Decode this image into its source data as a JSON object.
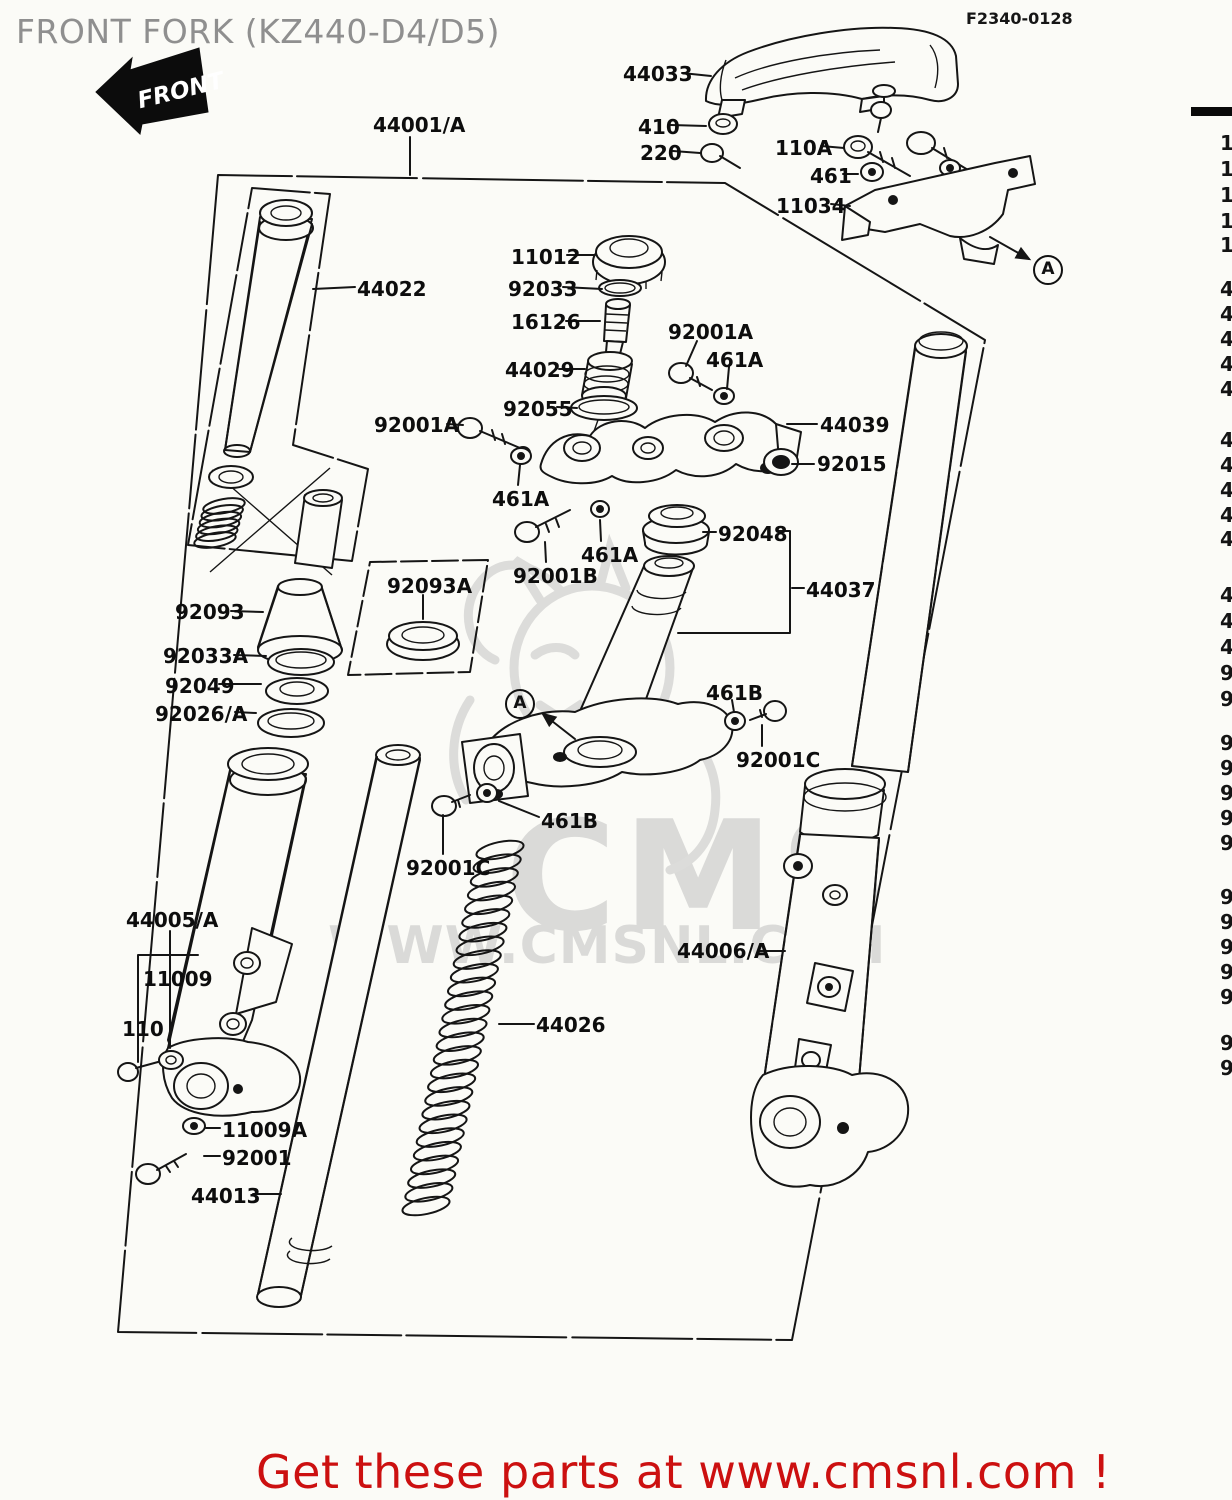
{
  "header": {
    "title": "FRONT FORK (KZ440-D4/D5)",
    "front_badge": "FRONT",
    "fiche_code": "F2340-0128"
  },
  "footer": {
    "promo": "Get these parts at www.cmsnl.com !"
  },
  "watermark": {
    "brand": "CMS",
    "url": "WWW.CMSNL.COM"
  },
  "colors": {
    "promo_red": "#cc1010",
    "title_gray": "#8f8f8f",
    "line_black": "#151515",
    "watermark_gray": "#dadad8",
    "background": "#fbfbf7"
  },
  "view_refs": [
    {
      "label": "A",
      "cx": 1046,
      "cy": 268,
      "arrow": [
        990,
        237,
        1029,
        259
      ]
    },
    {
      "label": "A",
      "cx": 518,
      "cy": 702,
      "arrow": [
        575,
        739,
        543,
        714
      ]
    }
  ],
  "part_labels": [
    {
      "text": "44033",
      "x": 623,
      "y": 62,
      "leader": [
        682,
        73,
        711,
        76
      ]
    },
    {
      "text": "410",
      "x": 638,
      "y": 115,
      "leader": [
        671,
        125,
        706,
        126
      ]
    },
    {
      "text": "220",
      "x": 640,
      "y": 141,
      "leader": [
        673,
        151,
        700,
        153
      ]
    },
    {
      "text": "110A",
      "x": 775,
      "y": 136,
      "leader": [
        821,
        146,
        844,
        148
      ]
    },
    {
      "text": "461",
      "x": 810,
      "y": 164,
      "leader": [
        843,
        174,
        858,
        174
      ]
    },
    {
      "text": "11034",
      "x": 776,
      "y": 194,
      "leader": [
        831,
        204,
        850,
        206
      ]
    },
    {
      "text": "44001/A",
      "x": 373,
      "y": 113,
      "leader": [
        410,
        137,
        410,
        175
      ]
    },
    {
      "text": "44022",
      "x": 357,
      "y": 277,
      "leader": [
        355,
        287,
        313,
        289
      ]
    },
    {
      "text": "11012",
      "x": 511,
      "y": 245,
      "leader": [
        567,
        255,
        595,
        255
      ]
    },
    {
      "text": "92033",
      "x": 508,
      "y": 277,
      "leader": [
        563,
        287,
        602,
        289
      ]
    },
    {
      "text": "16126",
      "x": 511,
      "y": 310,
      "leader": [
        566,
        321,
        600,
        321
      ]
    },
    {
      "text": "44029",
      "x": 505,
      "y": 358,
      "leader": [
        559,
        369,
        585,
        369
      ]
    },
    {
      "text": "92055",
      "x": 503,
      "y": 397,
      "leader": [
        557,
        407,
        577,
        408
      ]
    },
    {
      "text": "92001A",
      "x": 668,
      "y": 320,
      "leader": [
        697,
        341,
        686,
        366
      ]
    },
    {
      "text": "461A",
      "x": 706,
      "y": 348,
      "leader": [
        729,
        367,
        727,
        389
      ]
    },
    {
      "text": "44039",
      "x": 820,
      "y": 413,
      "leader": [
        817,
        424,
        787,
        424
      ]
    },
    {
      "text": "92015",
      "x": 817,
      "y": 452,
      "leader": [
        814,
        464,
        792,
        464
      ]
    },
    {
      "text": "92001A",
      "x": 374,
      "y": 413,
      "leader": [
        447,
        424,
        463,
        425
      ]
    },
    {
      "text": "461A",
      "x": 492,
      "y": 487,
      "leader": [
        518,
        485,
        520,
        465
      ]
    },
    {
      "text": "92001B",
      "x": 513,
      "y": 564,
      "leader": [
        546,
        562,
        545,
        542
      ]
    },
    {
      "text": "461A",
      "x": 581,
      "y": 543,
      "leader": [
        601,
        541,
        600,
        520
      ]
    },
    {
      "text": "92048",
      "x": 718,
      "y": 522,
      "leader": [
        716,
        532,
        703,
        532
      ]
    },
    {
      "text": "44037",
      "x": 806,
      "y": 578,
      "leader": [
        804,
        588,
        792,
        588
      ]
    },
    {
      "text": "461B",
      "x": 706,
      "y": 681,
      "leader": [
        732,
        700,
        734,
        712
      ]
    },
    {
      "text": "92001C",
      "x": 736,
      "y": 748,
      "leader": [
        762,
        746,
        762,
        725
      ]
    },
    {
      "text": "461B",
      "x": 541,
      "y": 809,
      "leader": [
        539,
        817,
        499,
        801
      ]
    },
    {
      "text": "92001C",
      "x": 406,
      "y": 856,
      "leader": [
        443,
        854,
        443,
        815
      ]
    },
    {
      "text": "92093",
      "x": 175,
      "y": 600,
      "leader": [
        231,
        611,
        263,
        612
      ]
    },
    {
      "text": "92033A",
      "x": 163,
      "y": 644,
      "leader": [
        234,
        655,
        266,
        656
      ]
    },
    {
      "text": "92049",
      "x": 165,
      "y": 674,
      "leader": [
        219,
        684,
        261,
        684
      ]
    },
    {
      "text": "92026/A",
      "x": 155,
      "y": 702,
      "leader": [
        235,
        712,
        256,
        713
      ]
    },
    {
      "text": "92093A",
      "x": 387,
      "y": 574,
      "leader": [
        423,
        595,
        423,
        619
      ]
    },
    {
      "text": "44005/A",
      "x": 126,
      "y": 908,
      "leader": [
        170,
        931,
        170,
        1048
      ]
    },
    {
      "text": "11009",
      "x": 143,
      "y": 967,
      "leader": null
    },
    {
      "text": "110",
      "x": 122,
      "y": 1017,
      "leader": null
    },
    {
      "text": "11009A",
      "x": 222,
      "y": 1118,
      "leader": [
        220,
        1128,
        206,
        1128
      ]
    },
    {
      "text": "92001",
      "x": 222,
      "y": 1146,
      "leader": [
        220,
        1156,
        204,
        1156
      ]
    },
    {
      "text": "44013",
      "x": 191,
      "y": 1184,
      "leader": [
        253,
        1194,
        281,
        1194
      ]
    },
    {
      "text": "44026",
      "x": 536,
      "y": 1013,
      "leader": [
        534,
        1024,
        499,
        1024
      ]
    },
    {
      "text": "44006/A",
      "x": 677,
      "y": 939,
      "leader": [
        759,
        951,
        785,
        951
      ]
    }
  ],
  "parts_table_edge": {
    "rows": [
      {
        "digit": "1",
        "y": 131
      },
      {
        "digit": "1",
        "y": 157
      },
      {
        "digit": "1",
        "y": 183
      },
      {
        "digit": "1",
        "y": 209
      },
      {
        "digit": "1",
        "y": 233
      },
      {
        "digit": "4",
        "y": 277
      },
      {
        "digit": "4",
        "y": 302
      },
      {
        "digit": "4",
        "y": 327
      },
      {
        "digit": "4",
        "y": 352
      },
      {
        "digit": "4",
        "y": 377
      },
      {
        "digit": "4",
        "y": 428
      },
      {
        "digit": "4",
        "y": 453
      },
      {
        "digit": "4",
        "y": 478
      },
      {
        "digit": "4",
        "y": 503
      },
      {
        "digit": "4",
        "y": 527
      },
      {
        "digit": "4",
        "y": 583
      },
      {
        "digit": "4",
        "y": 609
      },
      {
        "digit": "4",
        "y": 635
      },
      {
        "digit": "9",
        "y": 661
      },
      {
        "digit": "9",
        "y": 687
      },
      {
        "digit": "9",
        "y": 731
      },
      {
        "digit": "9",
        "y": 756
      },
      {
        "digit": "9",
        "y": 781
      },
      {
        "digit": "9",
        "y": 806
      },
      {
        "digit": "9",
        "y": 831
      },
      {
        "digit": "9",
        "y": 885
      },
      {
        "digit": "9",
        "y": 910
      },
      {
        "digit": "9",
        "y": 935
      },
      {
        "digit": "9",
        "y": 960
      },
      {
        "digit": "9",
        "y": 985
      },
      {
        "digit": "9",
        "y": 1031
      },
      {
        "digit": "9",
        "y": 1056
      }
    ]
  }
}
